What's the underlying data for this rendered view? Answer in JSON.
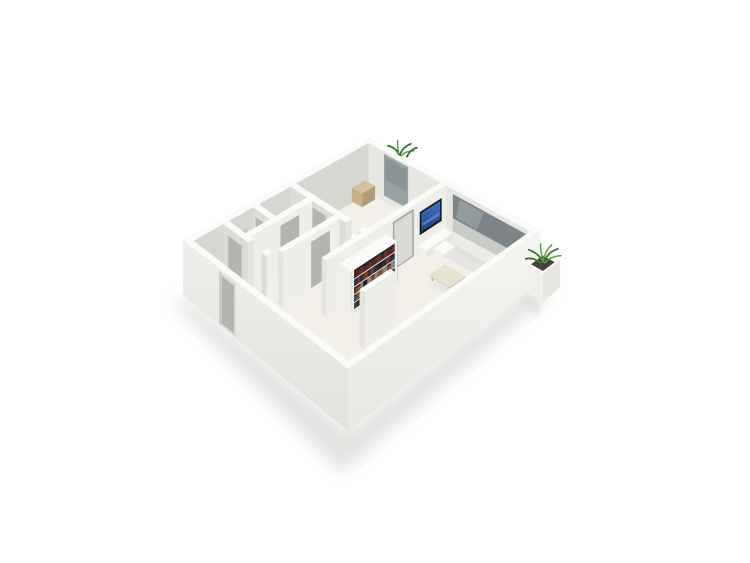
{
  "image": {
    "type": "3d-floor-plan-render",
    "description": "Isometric 3D floor plan render of a small one-bedroom apartment with white walls on a plain white background, viewed from above at an angle",
    "background": "#ffffff"
  },
  "palette": {
    "background": "#ffffff",
    "floor": "#f2f0e9",
    "floor_rug_strip": "#e4e4e0",
    "wall_top": "#fbfbf9",
    "wall_inner_shaded": "#d8d7d3",
    "wall_inner_light": "#e8e7e3",
    "wall_face_lit": "#efeee9",
    "wall_face_side": "#dddcd8",
    "wall_exterior_right": "#f3f3ef",
    "wall_exterior_left": "#ebebe7",
    "window_glass_dark": "#7d8487",
    "window_glass_mid": "#98a0a1",
    "window_glass_light": "#c9cbc7",
    "door_gray": "#b5b4b0",
    "door_frame": "#a9a8a4",
    "door_leaf_light": "#dbdad6",
    "ground_shadow": "#d9d9d6",
    "plant_green_dark": "#39742e",
    "plant_green_light": "#5ca243",
    "tv_frame": "#171b20",
    "tv_screen_blue": "#2f63b0",
    "bed_white": "#ffffff",
    "wood_tan": "#d6c29a",
    "coffee_table": "#e9e2d1",
    "planter_soil": "#46413a",
    "books": [
      "#6b2f28",
      "#8a4a33",
      "#3a3f5c",
      "#263049",
      "#6e5a40",
      "#54282c",
      "#8d867c",
      "#33322f",
      "#7c3b2a",
      "#45525f"
    ]
  },
  "scene": {
    "rooms": [
      {
        "name": "living-room",
        "position": "right half",
        "furniture": [
          "wall-mounted-tv",
          "tv-console",
          "small-bench",
          "bookshelf-with-books",
          "coffee-table",
          "long-window-band",
          "window-sill-ledge"
        ]
      },
      {
        "name": "bedroom",
        "position": "upper middle",
        "furniture": [
          "double-bed",
          "tan-box-dresser",
          "tan-box-nightstand",
          "corner-window"
        ]
      },
      {
        "name": "bathroom-and-closets",
        "position": "left cluster",
        "furniture": [
          "slatted-shelf",
          "gray-doors"
        ]
      },
      {
        "name": "hallway",
        "position": "lower left",
        "furniture": []
      }
    ],
    "exterior_features": [
      {
        "name": "entry-door",
        "position": "lower-left exterior wall, recessed"
      },
      {
        "name": "plant-on-wall",
        "position": "top wall above bedroom window"
      },
      {
        "name": "corner-planter-plant",
        "position": "right corner of building"
      },
      {
        "name": "soft-ground-shadow",
        "position": "below and right of building"
      }
    ]
  }
}
